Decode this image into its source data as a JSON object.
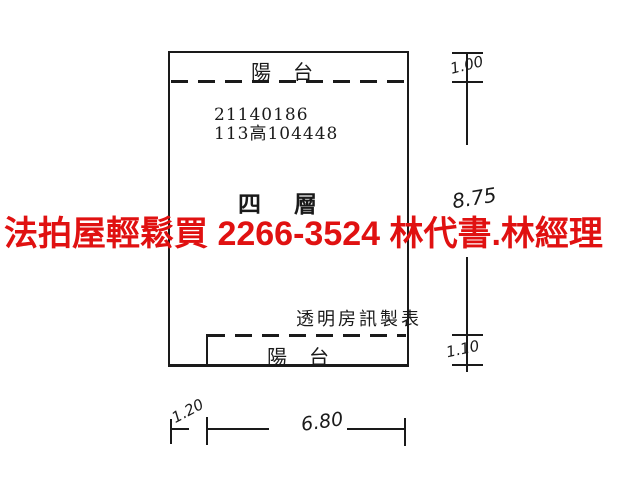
{
  "colors": {
    "background": "#ffffff",
    "line": "#1a1a1a",
    "ad_red": "#e01111"
  },
  "plan": {
    "top_balcony_label": "陽　台",
    "bottom_balcony_label": "陽　台",
    "case_number_line1": "21140186",
    "case_number_line2": "113高104448",
    "floor_label": "四　層",
    "maker_label": "透明房訊製表"
  },
  "ad_overlay": {
    "text": "法拍屋輕鬆買  2266-3524  林代書.林經理"
  },
  "dimensions": {
    "top_balcony_depth": "1.00",
    "body_height": "8.75",
    "bottom_balcony_depth": "1.10",
    "bottom_left_offset": "1.20",
    "body_width": "6.80"
  }
}
